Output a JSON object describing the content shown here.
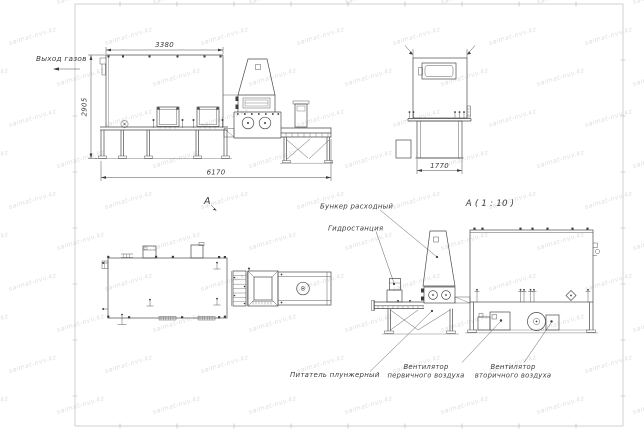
{
  "sheet": {
    "background": "#ffffff",
    "frame_color": "#b2b5ba",
    "line_color": "#4a4a4a",
    "text_color": "#3c3c3c"
  },
  "watermark": {
    "text": "saimat-nvv.kz",
    "color": "#bfc4cc"
  },
  "views": {
    "side": {
      "name_label": "А",
      "dim_top": "3380",
      "dim_left": "2905",
      "dim_bottom": "6170",
      "gas_outlet": "Выход газов"
    },
    "front": {
      "name_label": "А ( 1 : 10 )",
      "dim_bottom": "1770"
    },
    "rear": {
      "callout_bunker": "Бункер расходный",
      "callout_hydro": "Гидростанция",
      "callout_feeder": "Питатель плунжерный",
      "callout_fan1_line1": "Вентилятор",
      "callout_fan1_line2": "первичного воздуха",
      "callout_fan2_line1": "Вентилятор",
      "callout_fan2_line2": "вторичного воздуха"
    }
  }
}
